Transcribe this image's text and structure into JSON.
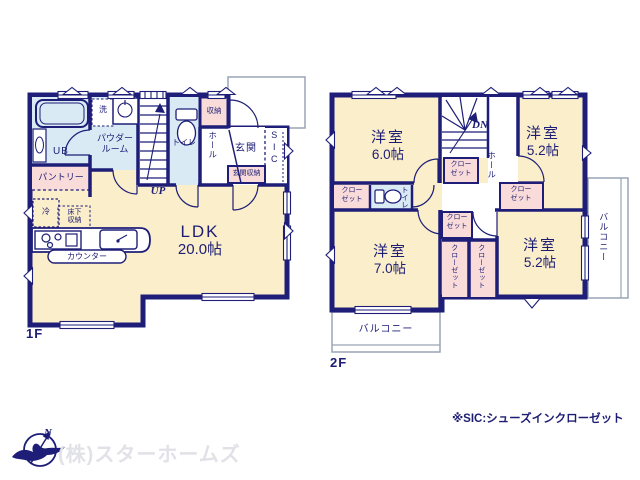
{
  "colors": {
    "wall": "#1e1e78",
    "room_fill": "#fbeecb",
    "wet_room_fill": "#d9eaf4",
    "closet_fill": "#f9dcd9",
    "balcony_line": "#9aa3b5",
    "watermark": "#e1e1e8"
  },
  "floor1": {
    "label": "1F",
    "ldk_name": "LDK",
    "ldk_area": "20.0帖",
    "ub": "UB",
    "powder_room": "パウダールーム",
    "pantry": "パントリー",
    "washer": "洗",
    "fridge": "冷",
    "underfloor_storage": "床下収納",
    "counter": "カウンター",
    "toilet": "トイレ",
    "storage": "収納",
    "hall": "ホール",
    "entrance": "玄関",
    "entrance_storage": "玄関収納",
    "sic": "SIC",
    "stairs_up": "UP"
  },
  "floor2": {
    "label": "2F",
    "room_nw_name": "洋室",
    "room_nw_area": "6.0帖",
    "room_ne_name": "洋室",
    "room_ne_area": "5.2帖",
    "room_sw_name": "洋室",
    "room_sw_area": "7.0帖",
    "room_se_name": "洋室",
    "room_se_area": "5.2帖",
    "closet": "クローゼット",
    "toilet": "トイレ",
    "hall": "ホール",
    "stairs_down": "DN",
    "balcony": "バルコニー"
  },
  "footer": {
    "sic_note": "※SIC:シューズインクローゼット",
    "company": "(株)スターホームズ",
    "north": "N"
  }
}
